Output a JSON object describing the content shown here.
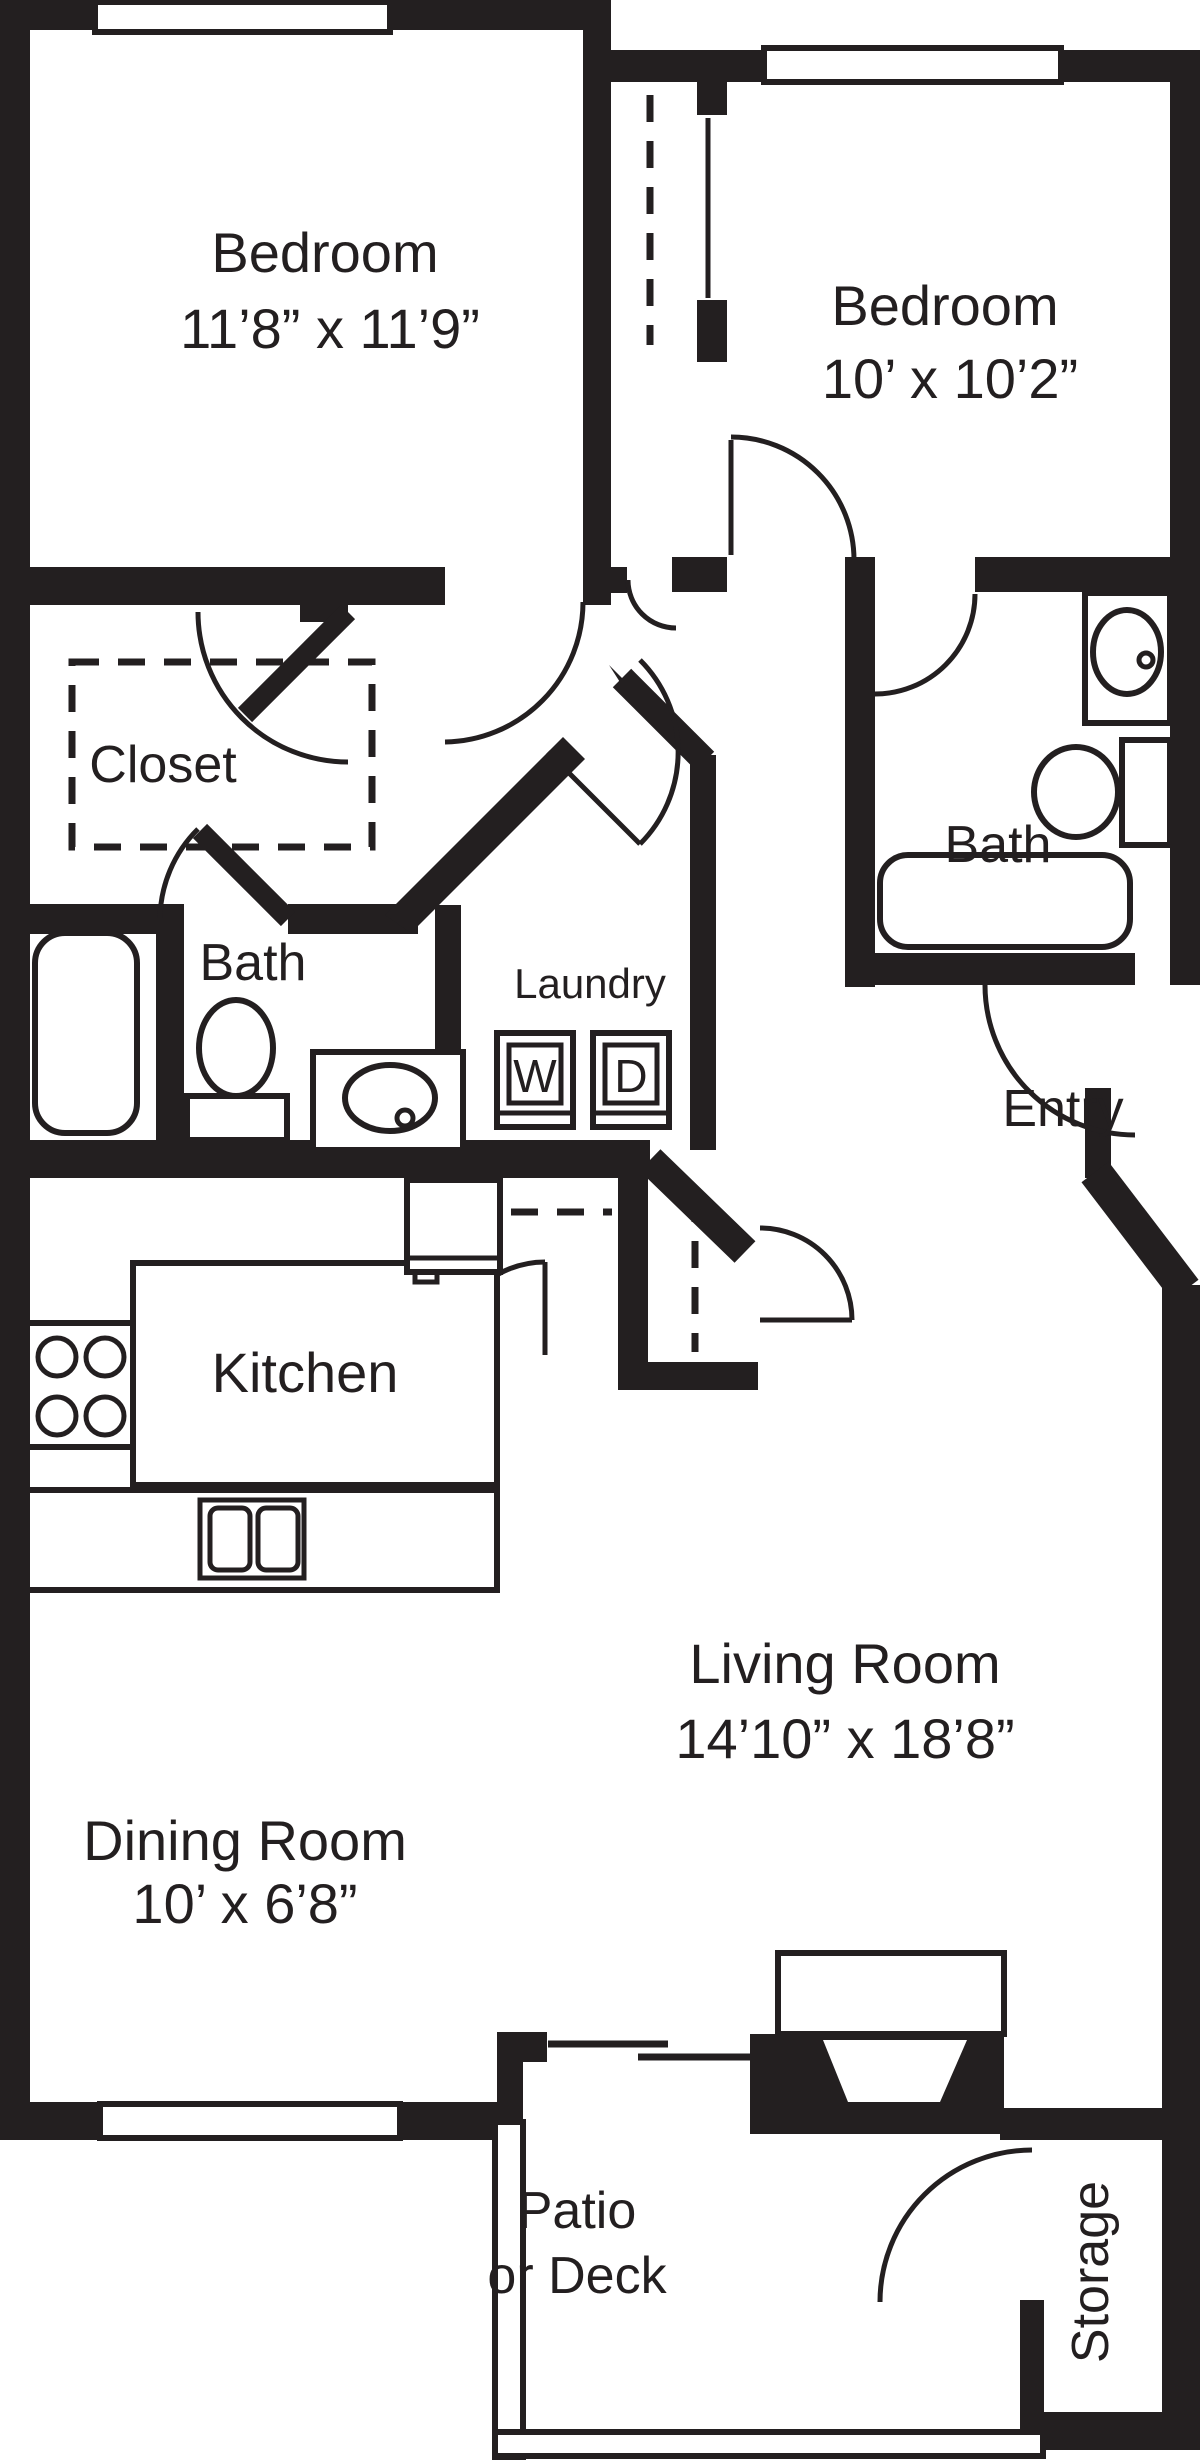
{
  "title": "Two Bedroom Apartment Floor Plan",
  "rooms": {
    "bedroom1": {
      "label": "Bedroom",
      "dims": "11’8” x 11’9”"
    },
    "bedroom2": {
      "label": "Bedroom",
      "dims": "10’ x 10’2”"
    },
    "closet": {
      "label": "Closet"
    },
    "bath1": {
      "label": "Bath"
    },
    "laundry": {
      "label": "Laundry"
    },
    "bath2": {
      "label": "Bath"
    },
    "entry": {
      "label": "Entry"
    },
    "kitchen": {
      "label": "Kitchen"
    },
    "living": {
      "label": "Living Room",
      "dims": "14’10” x 18’8”"
    },
    "dining": {
      "label": "Dining Room",
      "dims": "10’ x 6’8”"
    },
    "patio": {
      "label": "Patio",
      "label2": "or Deck"
    },
    "storage": {
      "label": "Storage"
    }
  },
  "appliances": {
    "washer": "W",
    "dryer": "D"
  },
  "colors": {
    "wall": "#231f20",
    "background": "#ffffff"
  }
}
